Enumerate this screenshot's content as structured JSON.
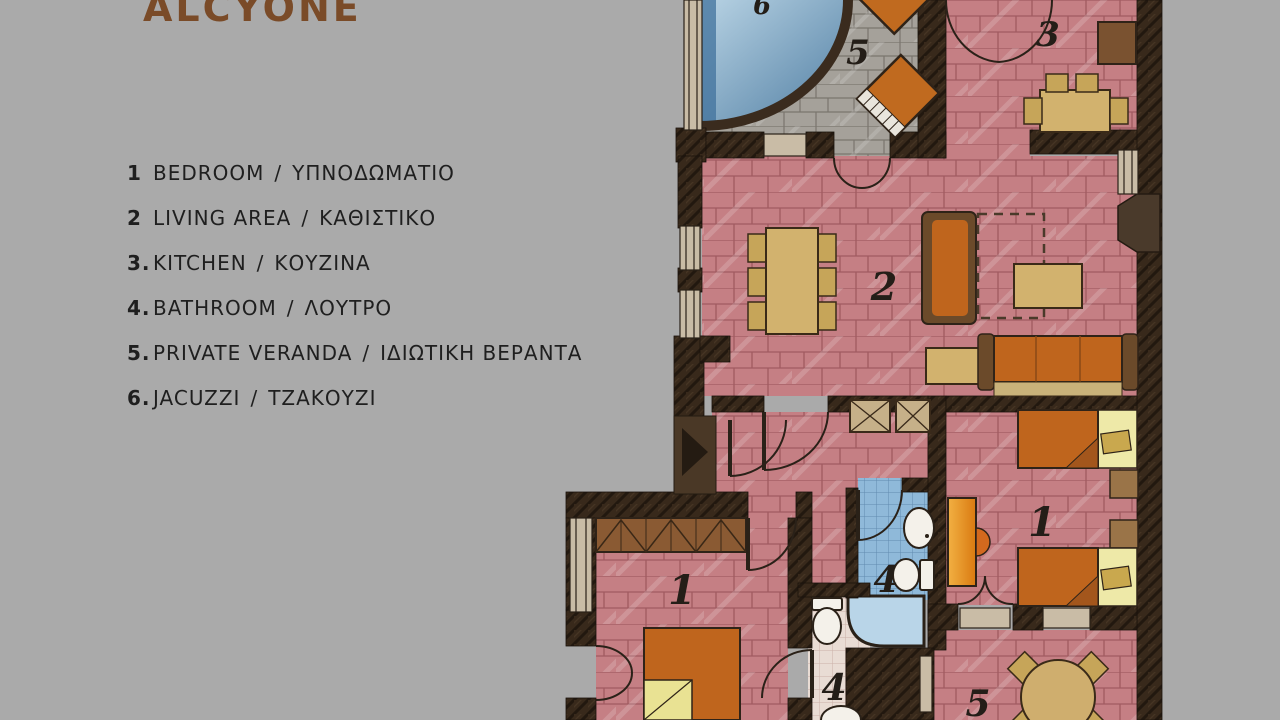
{
  "title": "ALCYONE",
  "legend": {
    "separator": "/",
    "items": [
      {
        "num": "1",
        "en": "BEDROOM",
        "gr": "ΥΠΝΟΔΩΜΑΤΙΟ"
      },
      {
        "num": "2",
        "en": "LIVING AREA",
        "gr": "ΚΑΘΙΣΤΙΚΟ"
      },
      {
        "num": "3.",
        "en": "KITCHEN",
        "gr": "ΚΟΥΖΙΝΑ"
      },
      {
        "num": "4.",
        "en": "BATHROOM",
        "gr": "ΛΟΥΤΡΟ"
      },
      {
        "num": "5.",
        "en": "PRIVATE VERANDA",
        "gr": "ΙΔΙΩΤΙΚΗ ΒΕΡΑΝΤΑ"
      },
      {
        "num": "6.",
        "en": "JACUZZI",
        "gr": "ΤΖΑΚΟΥΖΙ"
      }
    ]
  },
  "plan": {
    "labels": {
      "jacuzzi": "6",
      "veranda_top": "5",
      "kitchen": "3",
      "living": "2",
      "bedroom_right": "1",
      "bathroom_upper": "4",
      "bedroom_left": "1",
      "bathroom_lower": "4",
      "veranda_bottom": "5"
    },
    "colors": {
      "background": "#aaaaaa",
      "wall": "#38291b",
      "floor_pink": "#c57f84",
      "veranda_gray": "#a5a19a",
      "jacuzzi_blue": "#6f9cbd",
      "bath_blue": "#8fb9d9",
      "bath_white": "#e9dcd4",
      "furniture_tan": "#d2b26e",
      "furniture_orange": "#bf651d",
      "wood_brown": "#8a5a33",
      "title_brown": "#7a4b28"
    }
  }
}
